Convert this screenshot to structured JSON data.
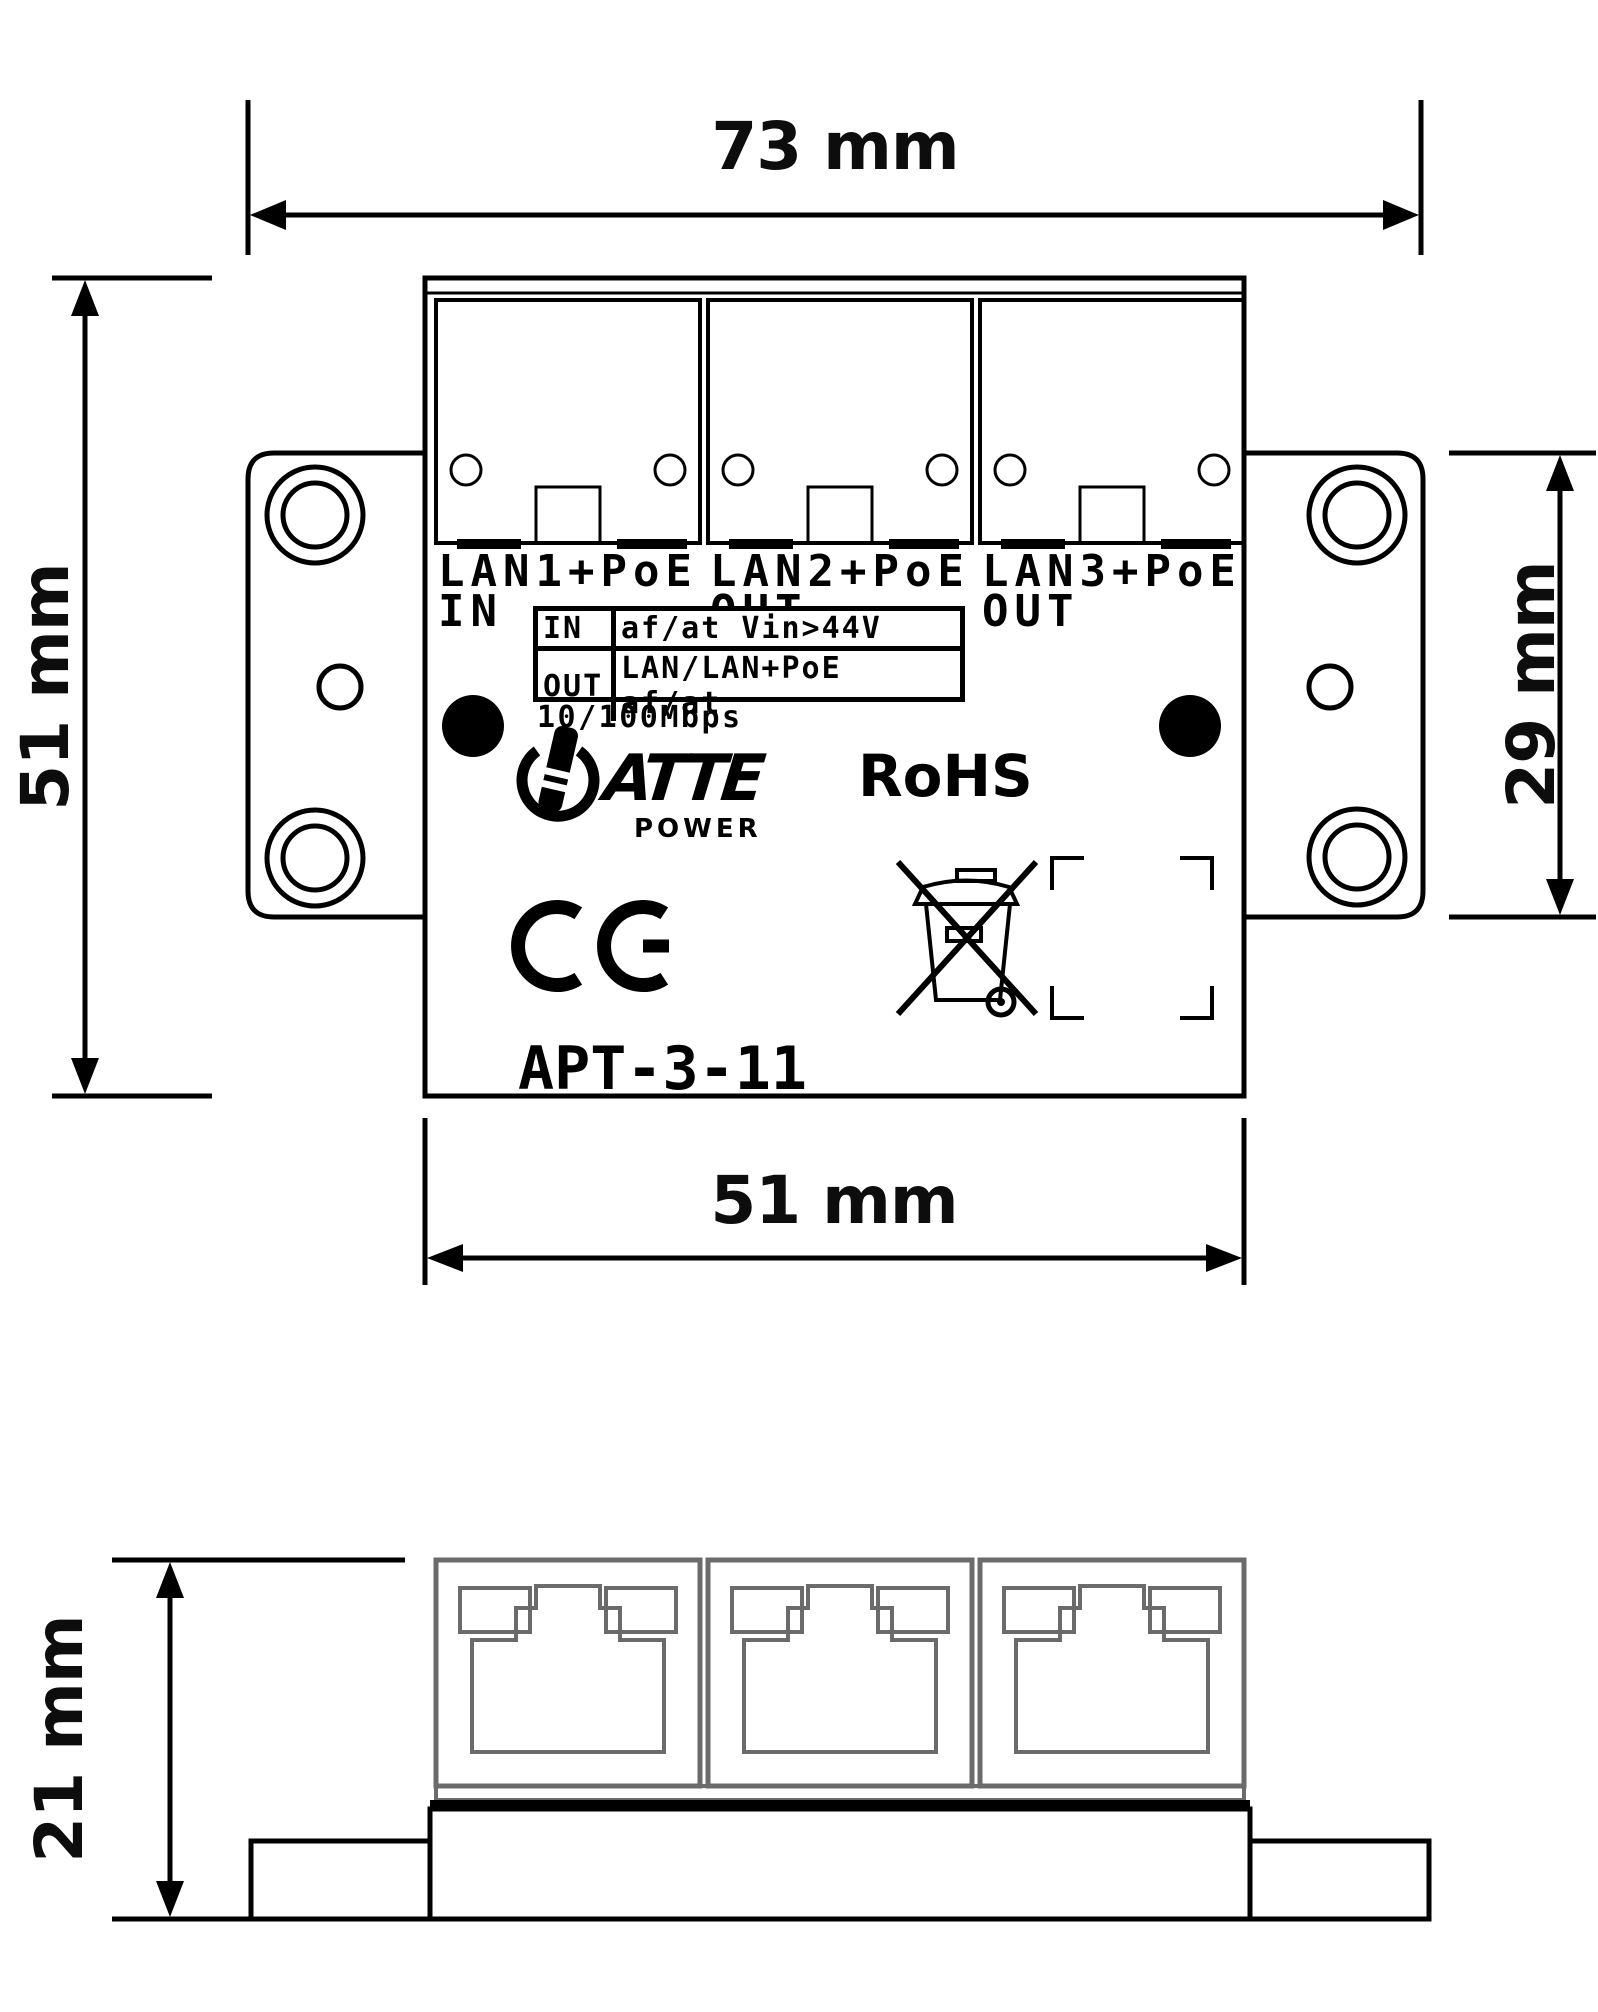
{
  "page": {
    "title": "APT-3-11 dimensional drawing",
    "background": "#ffffff"
  },
  "dimensions": {
    "total_width": "73 mm",
    "body_height": "51 mm",
    "bracket_height": "29 mm",
    "body_width": "51 mm",
    "side_height": "21 mm"
  },
  "device": {
    "model": "APT-3-11",
    "speed": "10/100Mbps",
    "brand": "ATTE",
    "brand_sub": "POWER",
    "rohs_label": "RoHS",
    "ports": [
      {
        "name": "LAN1+PoE",
        "direction": "IN"
      },
      {
        "name": "LAN2+PoE",
        "direction": "OUT"
      },
      {
        "name": "LAN3+PoE",
        "direction": "OUT"
      }
    ],
    "spec_table": {
      "rows": [
        {
          "key": "IN",
          "value": "af/at Vin>44V"
        },
        {
          "key": "OUT",
          "value": "LAN/LAN+PoE af/at"
        }
      ]
    }
  },
  "icons": {
    "power_symbol": "power-icon",
    "ce_mark": "CE",
    "weee": "crossed-out-wheelie-bin-icon"
  },
  "colors": {
    "line": "#000000",
    "jack_outline": "#6b6b6b",
    "background": "#ffffff"
  }
}
